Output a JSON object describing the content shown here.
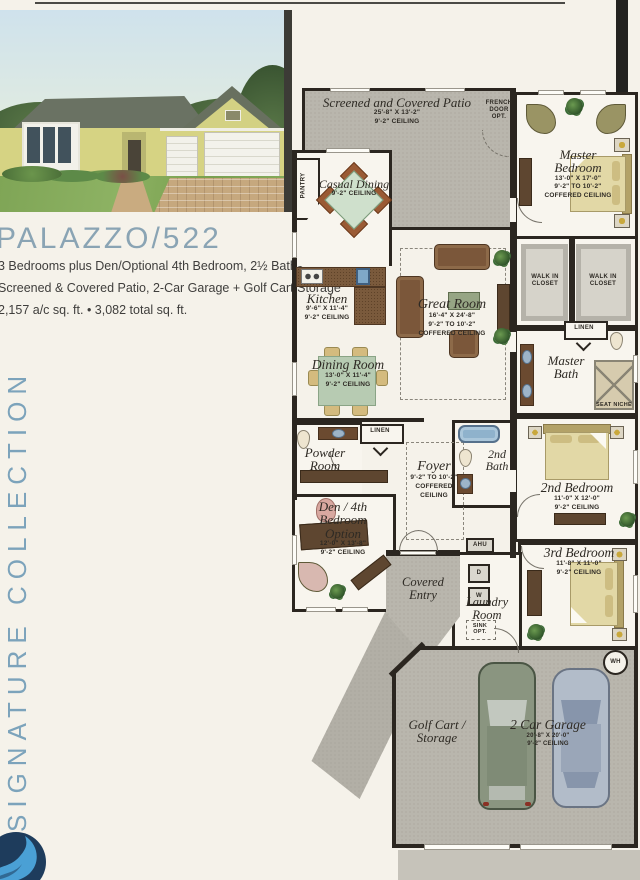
{
  "header": {
    "title": "PALAZZO/522",
    "line1": "3 Bedrooms plus Den/Optional 4th Bedroom, 2½ Baths,",
    "line2": "Screened & Covered Patio, 2-Car Garage + Golf Cart Storage",
    "line3": "2,157 a/c sq. ft. • 3,082 total sq. ft."
  },
  "sidebar": {
    "collection": "SIGNATURE COLLECTION"
  },
  "plan": {
    "patio": {
      "name": "Screened and Covered Patio",
      "dims": "25'-8\" X 13'-2\"",
      "ceiling": "9'-2\" CEILING"
    },
    "french_door_opt": "FRENCH DOOR OPT.",
    "master_bedroom": {
      "name": "Master Bedroom",
      "dims": "13'-0\" X 17'-0\"",
      "height": "9'-2\" TO 10'-2\"",
      "ceiling": "COFFERED CEILING"
    },
    "pantry": "PANTRY",
    "casual_dining": {
      "name": "Casual Dining",
      "ceiling": "9'-2\" CEILING"
    },
    "kitchen": {
      "name": "Kitchen",
      "dims": "9'-6\" X 11'-4\"",
      "ceiling": "9'-2\" CEILING"
    },
    "great_room": {
      "name": "Great Room",
      "dims": "16'-4\" X 24'-8\"",
      "height": "9'-2\" TO 10'-2\"",
      "ceiling": "COFFERED CEILING"
    },
    "walk_in_closet_left": "WALK IN CLOSET",
    "walk_in_closet_right": "WALK IN CLOSET",
    "linen_master": "LINEN",
    "master_bath": {
      "name": "Master Bath"
    },
    "seat_niche": "SEAT NICHE",
    "dining_room": {
      "name": "Dining Room",
      "dims": "13'-0\" X 11'-4\"",
      "ceiling": "9'-2\" CEILING"
    },
    "linen_hall": "LINEN",
    "powder_room": {
      "name": "Powder Room"
    },
    "foyer": {
      "name": "Foyer",
      "height": "9'-2\" TO 10'-2\"",
      "ceiling": "COFFERED CEILING"
    },
    "second_bath": {
      "name": "2nd Bath"
    },
    "second_bedroom": {
      "name": "2nd Bedroom",
      "dims": "11'-0\" X 12'-0\"",
      "ceiling": "9'-2\" CEILING"
    },
    "den": {
      "name": "Den / 4th Bedroom Option",
      "dims": "12'-0\" X 13'-8\"",
      "ceiling": "9'-2\" CEILING"
    },
    "third_bedroom": {
      "name": "3rd Bedroom",
      "dims": "11'-8\" X 11'-0\"",
      "ceiling": "9'-2\" CEILING"
    },
    "covered_entry": {
      "name": "Covered Entry"
    },
    "laundry": {
      "name": "Laundry Room",
      "sink_opt": "SINK OPT."
    },
    "ahu": "AHU",
    "dryer": "D",
    "washer": "W",
    "water_heater": "WH",
    "golf_cart_storage": {
      "name": "Golf Cart / Storage"
    },
    "garage": {
      "name": "2 Car Garage",
      "dims": "20'-8\" X 20'-0\"",
      "ceiling": "9'-2\" CEILING"
    }
  },
  "colors": {
    "accent_blue": "#7fa5ba",
    "wall_dark": "#2b2620",
    "patio_gray": "#b9b6ad",
    "logo_navy": "#1e3c5c",
    "logo_light_blue": "#4aa0d5"
  }
}
